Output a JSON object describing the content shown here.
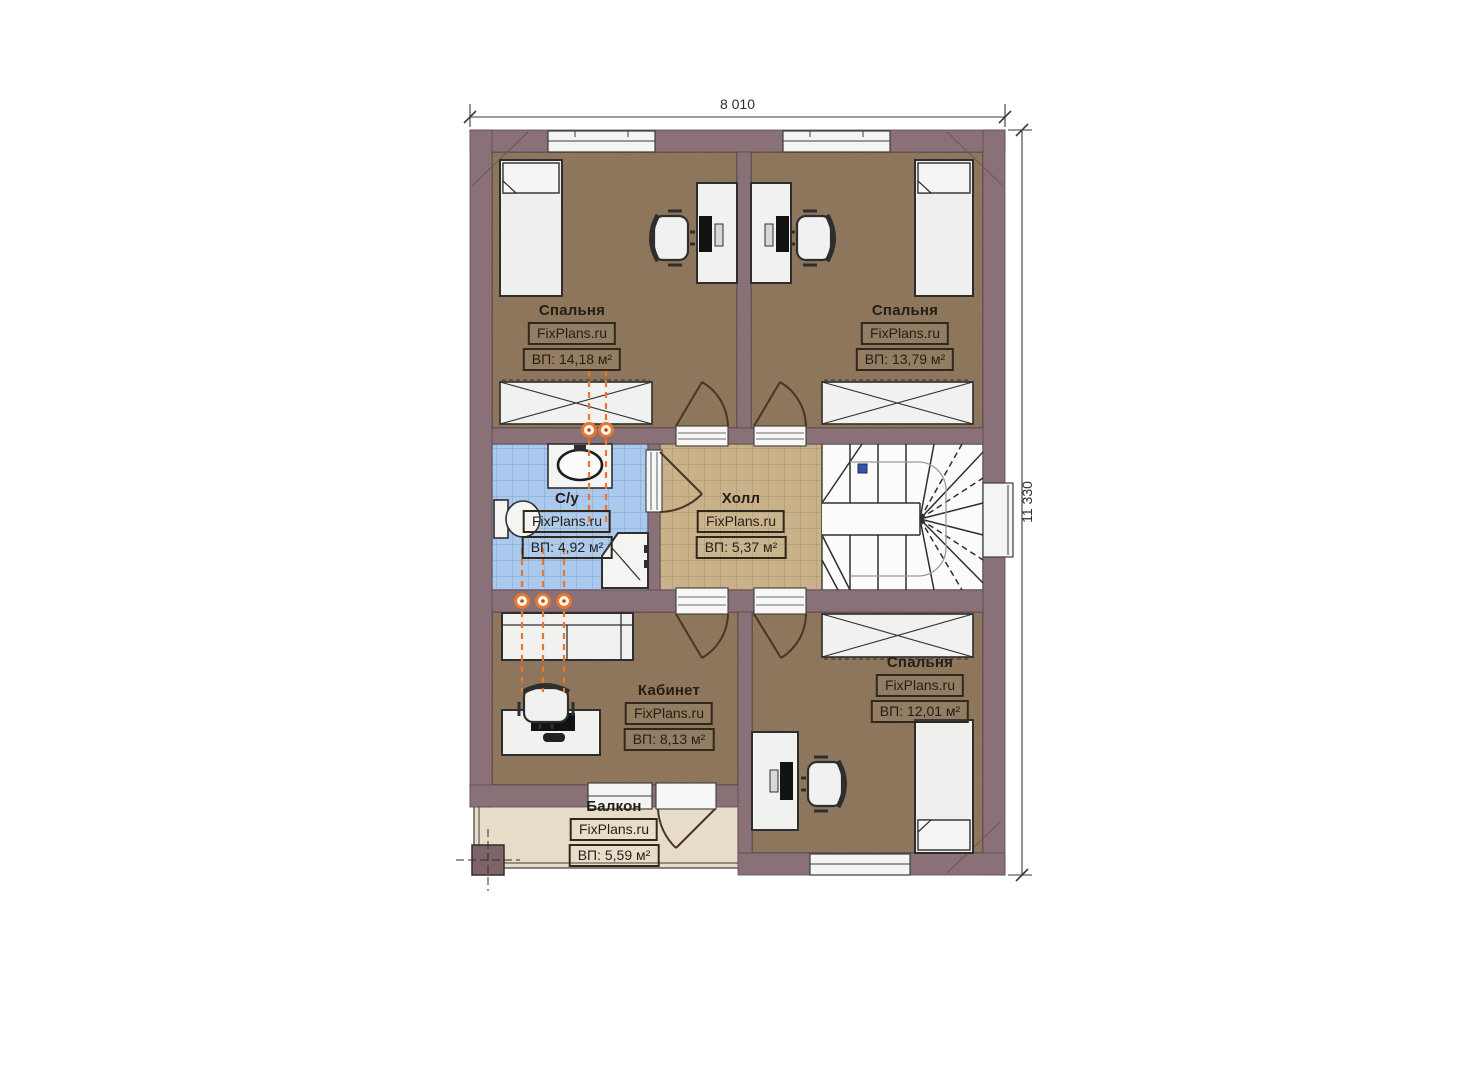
{
  "plan": {
    "dim_width": "8 010",
    "dim_height": "11 330",
    "rooms": {
      "bedroom_top_left": {
        "name": "Спальня",
        "brand": "FixPlans.ru",
        "area": "ВП: 14,18 м²"
      },
      "bedroom_top_right": {
        "name": "Спальня",
        "brand": "FixPlans.ru",
        "area": "ВП: 13,79 м²"
      },
      "bathroom": {
        "name": "С/у",
        "brand": "FixPlans.ru",
        "area": "ВП: 4,92 м²"
      },
      "hall": {
        "name": "Холл",
        "brand": "FixPlans.ru",
        "area": "ВП: 5,37 м²"
      },
      "office": {
        "name": "Кабинет",
        "brand": "FixPlans.ru",
        "area": "ВП: 8,13 м²"
      },
      "bedroom_bottom": {
        "name": "Спальня",
        "brand": "FixPlans.ru",
        "area": "ВП: 12,01 м²"
      },
      "balcony": {
        "name": "Балкон",
        "brand": "FixPlans.ru",
        "area": "ВП: 5,59 м²"
      }
    },
    "colors": {
      "wall": "#8a7077",
      "floor_wood": "#8b7157",
      "floor_hall": "#c9b289",
      "floor_bath": "#abc9ed",
      "floor_balcony": "#e7dcc7",
      "heater_accent": "#e8762c"
    }
  }
}
